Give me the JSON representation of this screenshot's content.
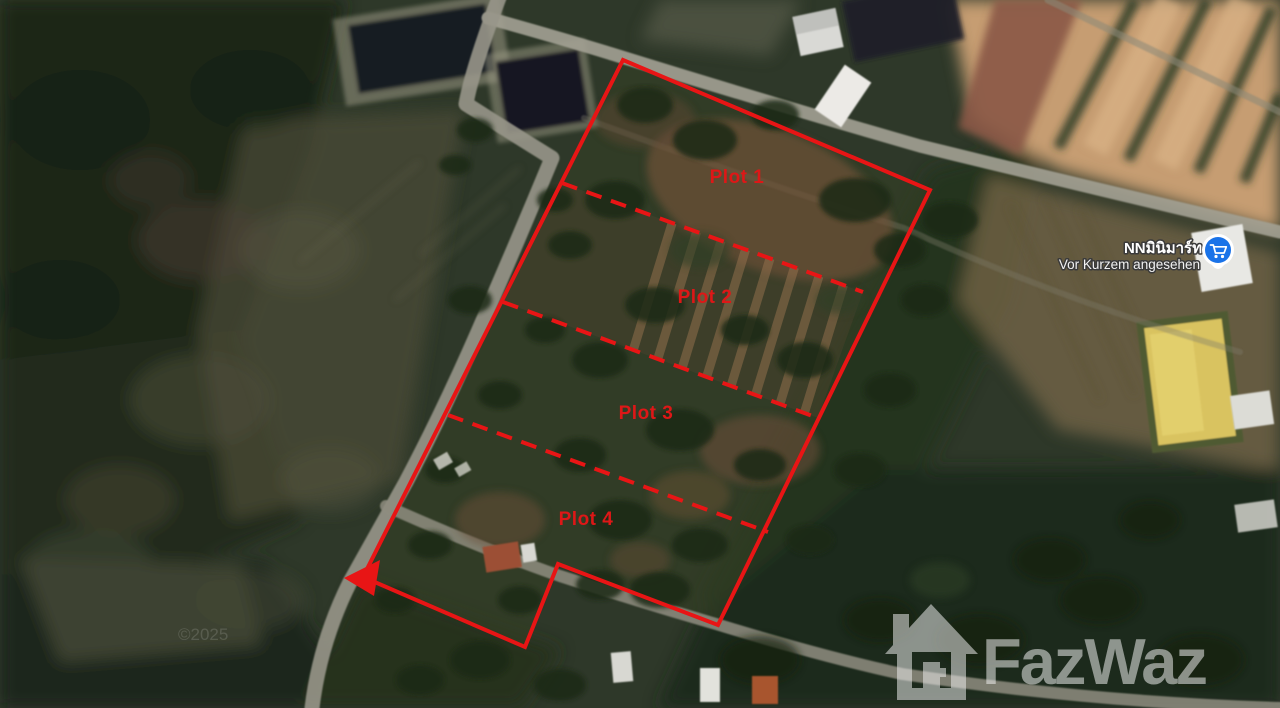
{
  "map": {
    "view_type": "satellite",
    "copyright": "©2025",
    "overlay_color": "#e81515",
    "plots": [
      {
        "label": "Plot 1"
      },
      {
        "label": "Plot 2"
      },
      {
        "label": "Plot 3"
      },
      {
        "label": "Plot 4"
      }
    ]
  },
  "poi": {
    "name": "NNมินิมาร์ท",
    "status": "Vor Kurzem angesehen",
    "icon": "shopping-cart-icon",
    "pin_color": "#1a73e8"
  },
  "brand": {
    "name": "FazWaz",
    "icon": "house-logo-icon",
    "color": "#ffffff"
  }
}
